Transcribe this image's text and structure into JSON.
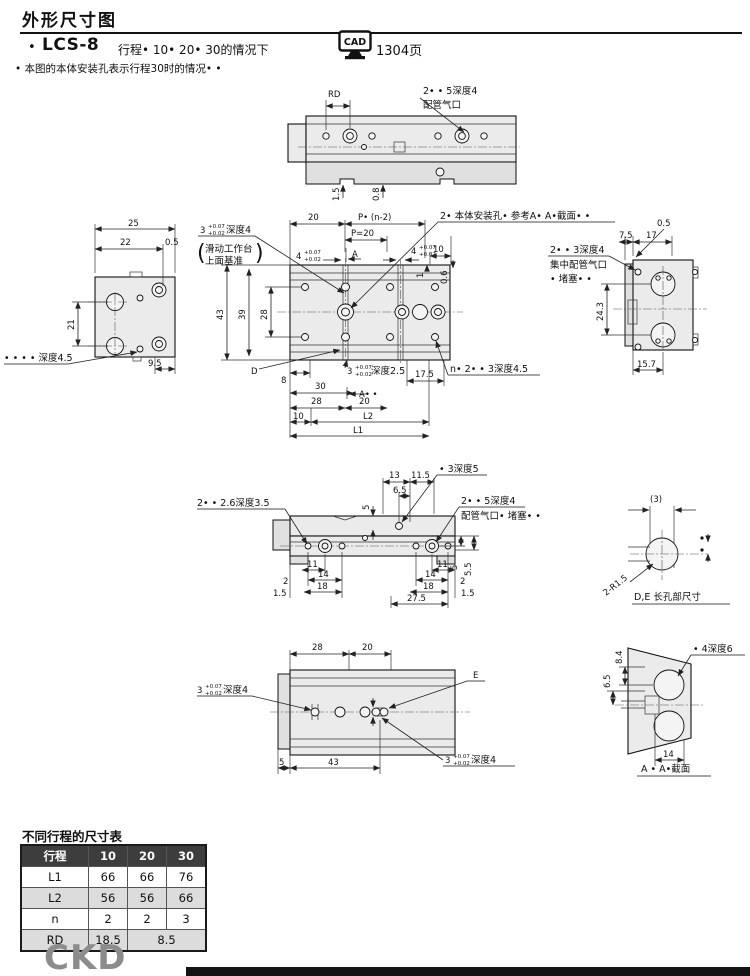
{
  "header": {
    "page_title": "外形尺寸图",
    "model_bullet": "•",
    "model": "LCS-8",
    "stroke_case": "行程• 10• 20• 30的情况下",
    "cad_icon_label": "CAD",
    "cad_page": "1304页",
    "note": "• 本图的本体安装孔表示行程30时的情况• •"
  },
  "tol": {
    "hi": "+0.07",
    "lo": "+0.02"
  },
  "top_view": {
    "rd_label": "RD",
    "port_line1": "2• • 5深度4",
    "port_line2": "配管气口",
    "dim_1_5": "1.5",
    "dim_0_8": "0.8"
  },
  "end_view_left": {
    "dim_25": "25",
    "dim_22": "22",
    "dim_0_5": "0.5",
    "dim_21": "21",
    "depth_note": "• • • • 深度4.5",
    "dim_9_5": "9.5"
  },
  "plan_view": {
    "slot_note_num": "3",
    "slot_note_suffix": "深度4",
    "datum_paren_l": "(",
    "datum_line1": "滑动工作台",
    "datum_line2": "上面基准",
    "datum_paren_r": ")",
    "dim_20_top": "20",
    "pitch_label": "P• (n-2)",
    "pitch_value": "P=20",
    "slot4_num": "4",
    "dim_10": "10",
    "dim_1": "1",
    "dim_0_6": "0.6",
    "a_marker": "A",
    "mount_note": "2• 本体安装孔• 参考A• A•截面• •",
    "dim_43": "43",
    "dim_39": "39",
    "dim_28_left": "28",
    "d_label": "D",
    "dim_8": "8",
    "slot25_num": "3",
    "slot25_suffix": "深度2.5",
    "dim_17_5": "17.5",
    "dim_30": "30",
    "aa_marker": "A• •",
    "dim_28": "28",
    "dim_20": "20",
    "dim_10_b": "10",
    "l2_label": "L2",
    "l1_label": "L1",
    "n_note": "n• 2• • 3深度4.5"
  },
  "end_view_right": {
    "dim_0_5": "0.5",
    "dim_7_5": "7.5",
    "dim_17": "17",
    "port_line1": "2• • 3深度4",
    "port_line2": "集中配管气口",
    "port_line3": "• 堵塞• •",
    "dim_24_3": "24.3",
    "dim_15_7": "15.7"
  },
  "side_view": {
    "hole_note_left": "2• • 2.6深度3.5",
    "dim_13": "13",
    "dim_11_5": "11.5",
    "dim_6_5": "6.5",
    "dim_5_top": "5",
    "hole_note_top": "• 3深度5",
    "port_line1": "2• • 5深度4",
    "port_line2": "配管气口• 堵塞• •",
    "dim_5_5": "5.5",
    "dim_5_right": "5",
    "dim_11_l": "11",
    "dim_11_r": "11",
    "dim_2_l": "2",
    "dim_14_l": "14",
    "dim_14_r": "14",
    "dim_2_r": "2",
    "dim_1_5_l": "1.5",
    "dim_18_l": "18",
    "dim_18_r": "18",
    "dim_1_5_r": "1.5",
    "dim_27_5": "27.5"
  },
  "slot_detail": {
    "dim_3": "(3)",
    "radius_note": "2-R1.5",
    "caption": "D,E 长孔部尺寸"
  },
  "bottom_view": {
    "dim_28": "28",
    "dim_20": "20",
    "slot_note_num": "3",
    "slot_note_suffix": "深度4",
    "e_label": "E",
    "dim_5": "5",
    "dim_43": "43",
    "slot_note2_num": "3",
    "slot_note2_suffix": "深度4"
  },
  "section_view": {
    "dim_8_4": "8.4",
    "dim_6_5": "6.5",
    "hole_note": "• 4深度6",
    "dim_14": "14",
    "caption": "A • A•截面"
  },
  "stroke_table": {
    "title": "不同行程的尺寸表",
    "header": [
      "行程",
      "10",
      "20",
      "30"
    ],
    "rows": [
      {
        "label": "L1",
        "values": [
          "66",
          "66",
          "76"
        ]
      },
      {
        "label": "L2",
        "values": [
          "56",
          "56",
          "66"
        ]
      },
      {
        "label": "n",
        "values": [
          "2",
          "2",
          "3"
        ]
      },
      {
        "label": "RD",
        "values": [
          "18.5",
          "8.5"
        ]
      }
    ]
  },
  "footer": {
    "logo": "CKD"
  }
}
